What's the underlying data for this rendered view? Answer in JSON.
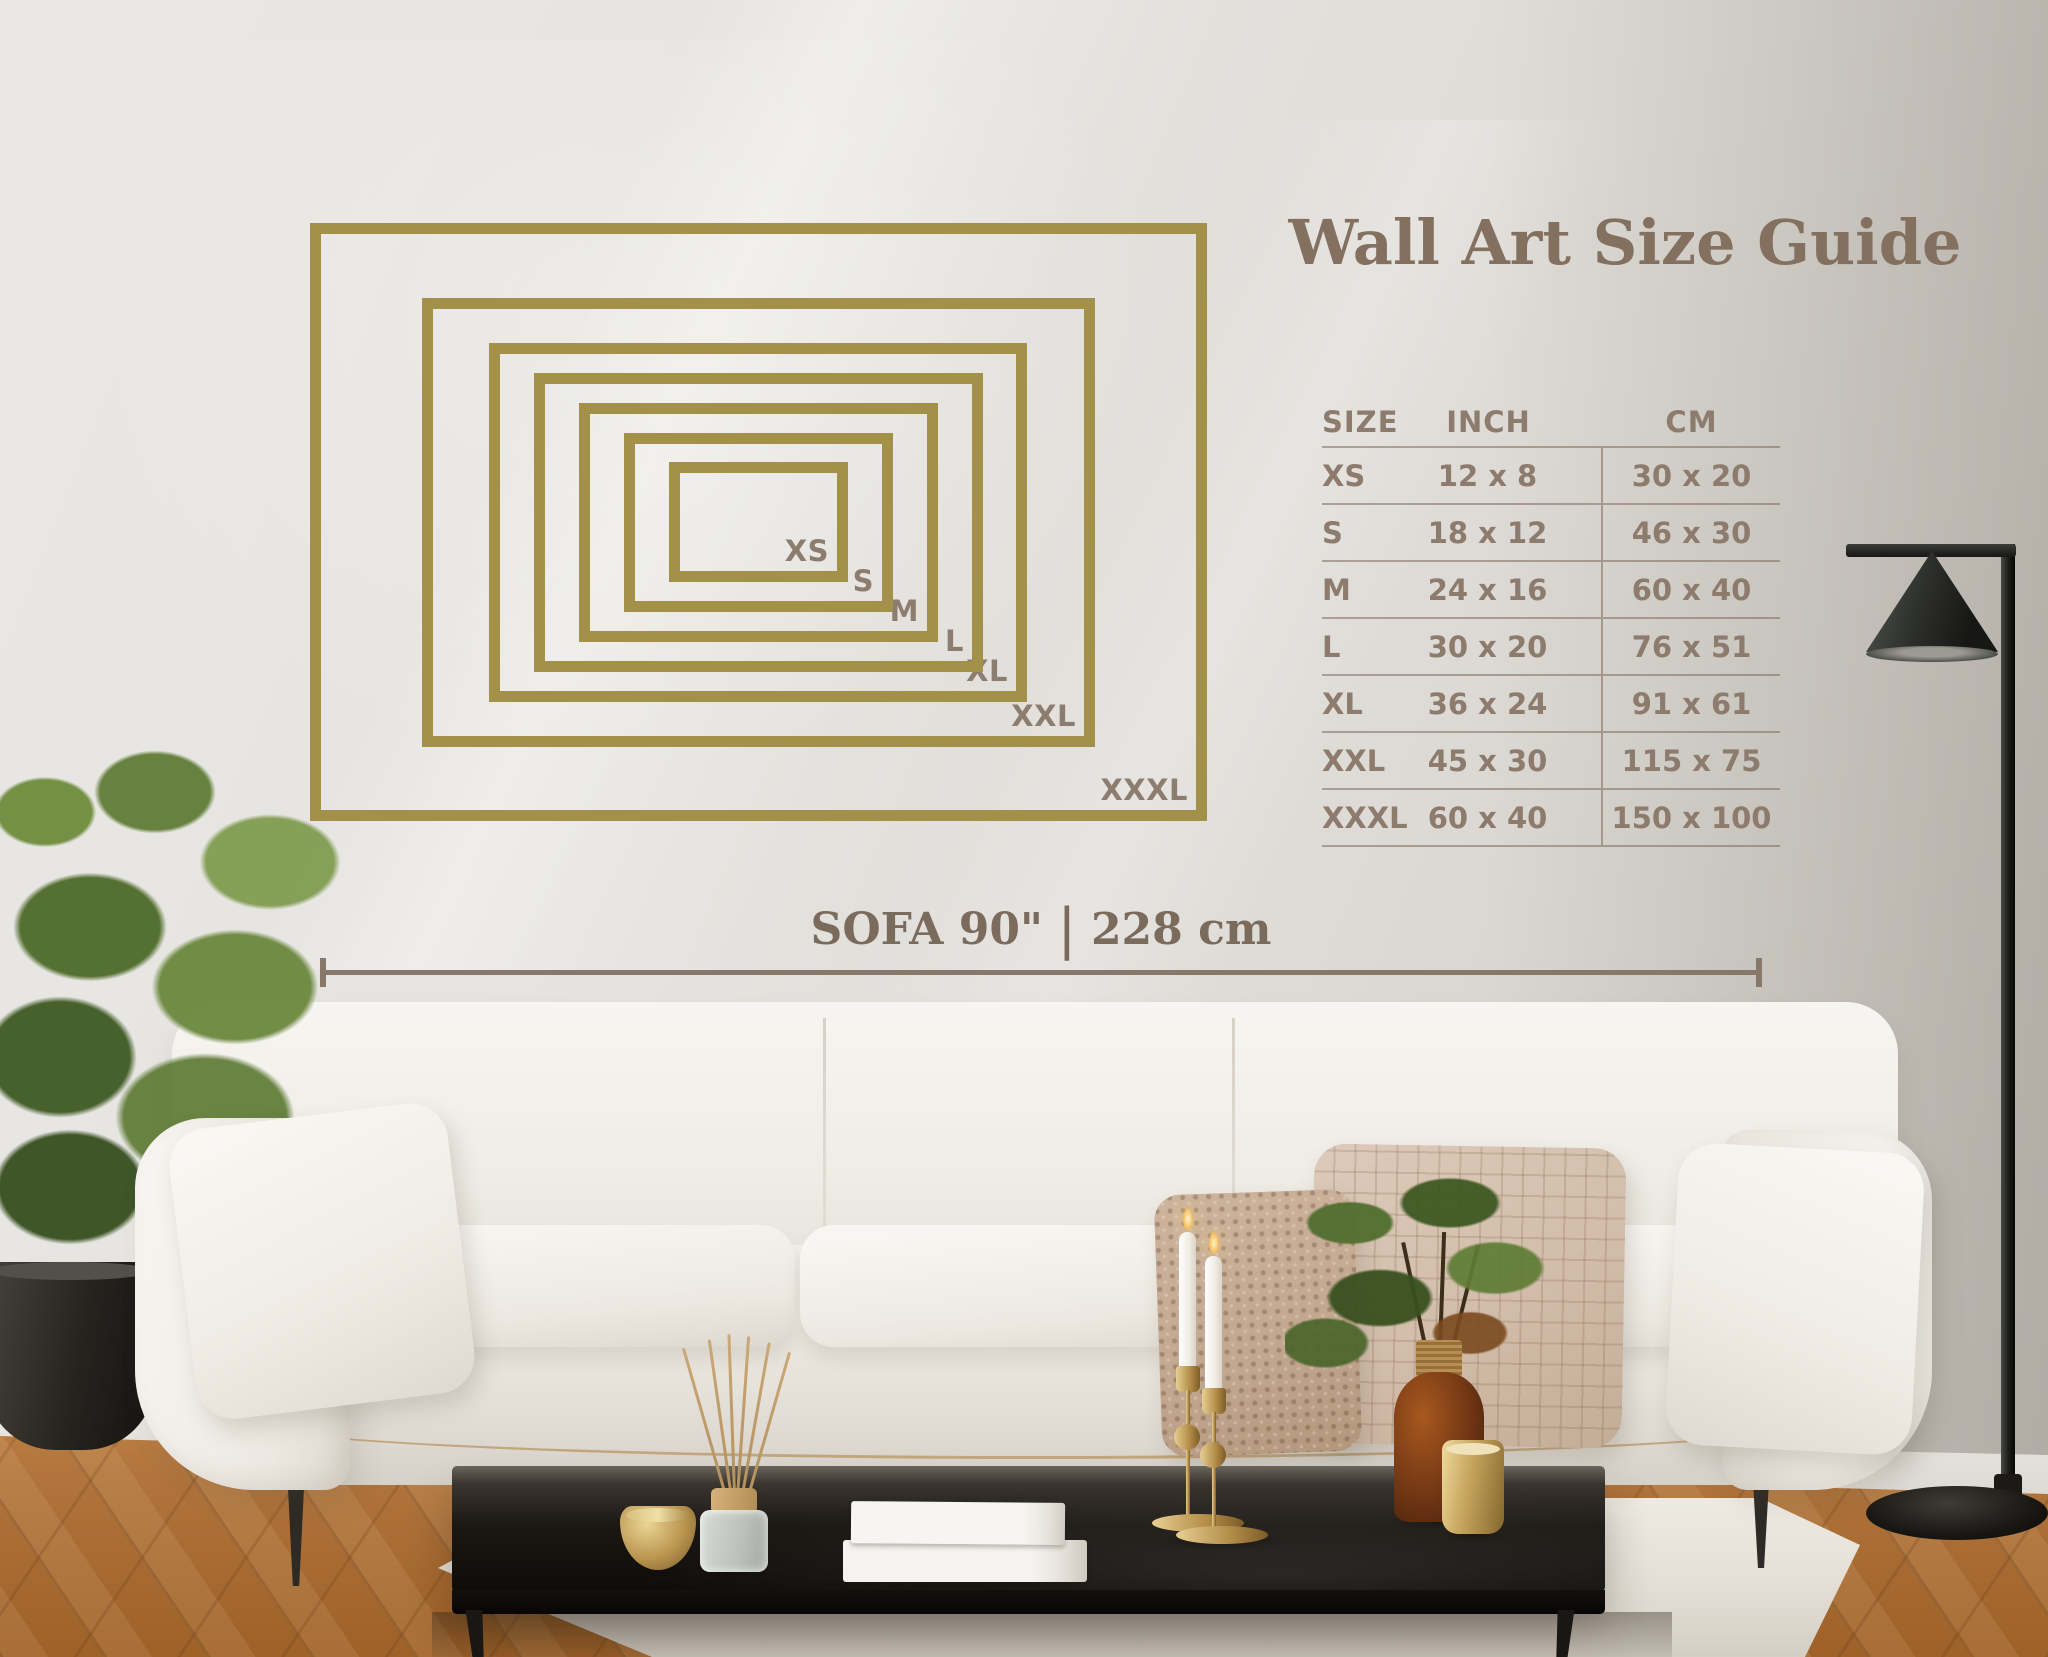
{
  "title": "Wall Art Size Guide",
  "size_guide": {
    "frames": [
      {
        "label": "XS",
        "inch_w": 12,
        "inch_h": 8
      },
      {
        "label": "S",
        "inch_w": 18,
        "inch_h": 12
      },
      {
        "label": "M",
        "inch_w": 24,
        "inch_h": 16
      },
      {
        "label": "L",
        "inch_w": 30,
        "inch_h": 20
      },
      {
        "label": "XL",
        "inch_w": 36,
        "inch_h": 24
      },
      {
        "label": "XXL",
        "inch_w": 45,
        "inch_h": 30
      },
      {
        "label": "XXXL",
        "inch_w": 60,
        "inch_h": 40
      }
    ]
  },
  "size_table": {
    "headers": [
      "SIZE",
      "INCH",
      "CM"
    ],
    "rows": [
      {
        "size": "XS",
        "inch": "12 x 8",
        "cm": "30 x 20"
      },
      {
        "size": "S",
        "inch": "18 x 12",
        "cm": "46 x 30"
      },
      {
        "size": "M",
        "inch": "24 x 16",
        "cm": "60 x 40"
      },
      {
        "size": "L",
        "inch": "30 x 20",
        "cm": "76 x 51"
      },
      {
        "size": "XL",
        "inch": "36 x 24",
        "cm": "91 x 61"
      },
      {
        "size": "XXL",
        "inch": "45 x 30",
        "cm": "115 x 75"
      },
      {
        "size": "XXXL",
        "inch": "60 x 40",
        "cm": "150 x 100"
      }
    ]
  },
  "sofa_measurement": {
    "label_inches": "SOFA 90\"",
    "separator": "|",
    "label_cm": "228 cm"
  },
  "palette": {
    "frame_gold": "#a3914a",
    "text_brown": "#83705f",
    "table_text": "#8d7b6d",
    "measure_line": "#87786a",
    "wall": "#e3e1dd"
  }
}
